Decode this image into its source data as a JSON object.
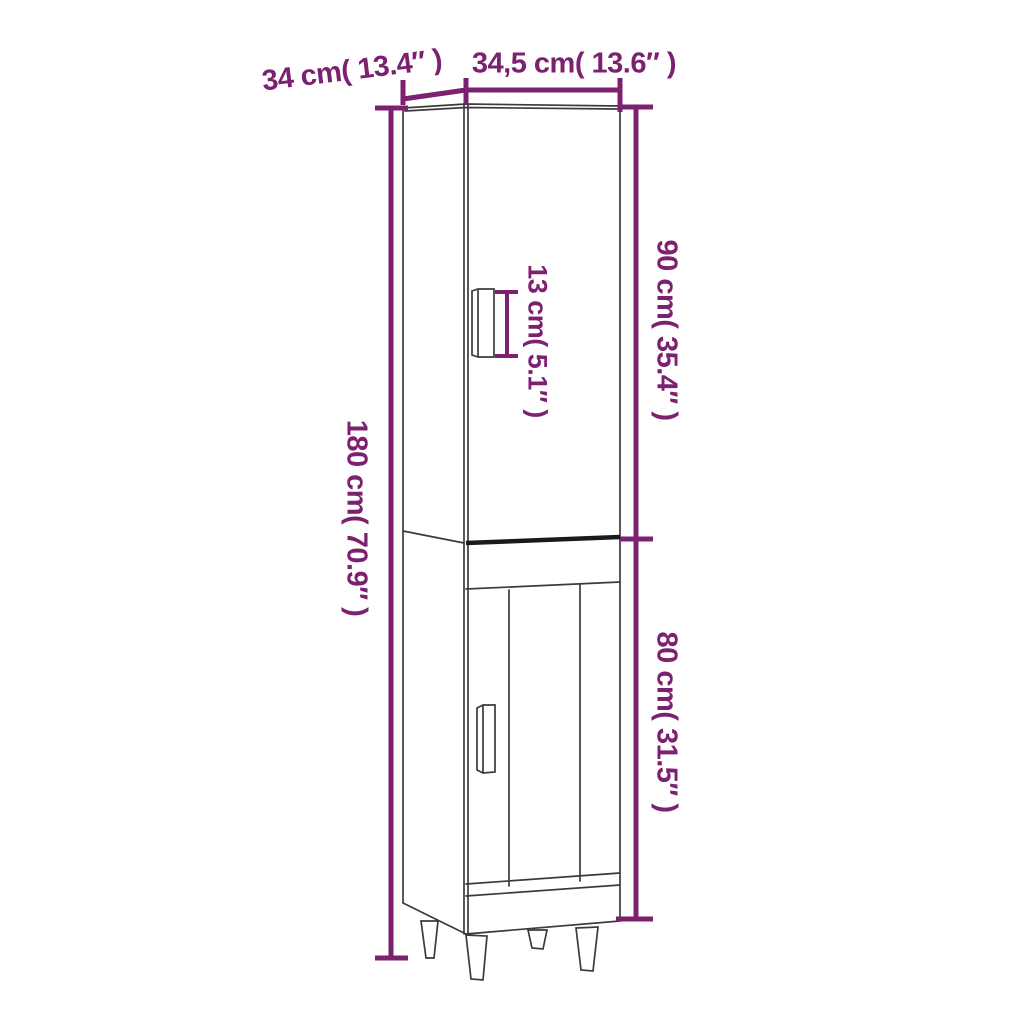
{
  "diagram": {
    "type": "product-dimension-diagram",
    "subject": "tall-cabinet-line-drawing",
    "labels": {
      "depth_top": "34 cm( 13.4″ )",
      "width_top": "34,5 cm( 13.6″ )",
      "height_upper_right": "90 cm( 35.4″ )",
      "height_lower_right": "80 cm( 31.5″ )",
      "height_total_left": "180 cm( 70.9″ )",
      "handle_height": "13 cm( 5.1″ )"
    },
    "colors": {
      "dimension_accent": "#7c2170",
      "outline": "#3d3a3c",
      "junction_heavy_line": "#1a1a1a",
      "background": "#ffffff"
    }
  }
}
